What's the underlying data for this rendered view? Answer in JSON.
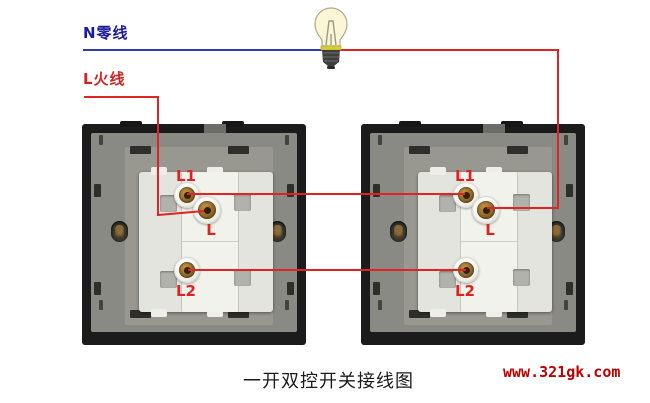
{
  "labels": {
    "neutral": "N零线",
    "live": "L火线",
    "caption": "一开双控开关接线图",
    "watermark": "www.321gk.com"
  },
  "colors": {
    "neutral_wire": "#2b3cb8",
    "live_wire": "#e02424",
    "neutral_text": "#1c1c9e",
    "live_text": "#d42222",
    "terminal_label": "#dd2222",
    "watermark_text": "#c00000"
  },
  "switches": [
    {
      "name": "switch-left",
      "terminals": {
        "t1": "L1",
        "t2": "L",
        "t3": "L2"
      }
    },
    {
      "name": "switch-right",
      "terminals": {
        "t1": "L1",
        "t2": "L",
        "t3": "L2"
      }
    }
  ],
  "wires": [
    {
      "name": "neutral-wire",
      "color": "#2b3cb8",
      "points": "83,50 331,50"
    },
    {
      "name": "live-wire-bulb-to-right-switch-L",
      "color": "#e02424",
      "points": "331,50 558,50 558,208 487,208"
    },
    {
      "name": "live-wire-feed-to-left-switch-L",
      "color": "#e02424",
      "points": "84,97 158,97 158,215 204,211"
    },
    {
      "name": "traveler-wire-L1-to-L1",
      "color": "#e02424",
      "points": "187,194 465,194"
    },
    {
      "name": "traveler-wire-L2-to-L2",
      "color": "#e02424",
      "points": "188,270 466,270"
    }
  ]
}
